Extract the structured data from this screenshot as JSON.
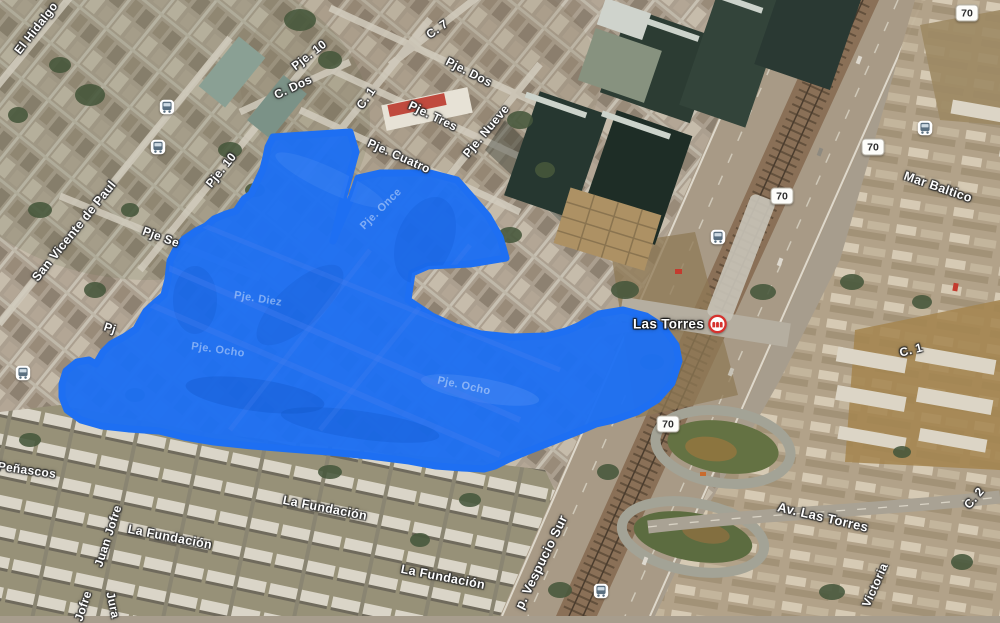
{
  "map": {
    "description": "Aerial satellite map with blue freehand area selection overlay, Las Torres / Av. Vespucio Sur area",
    "street_labels": [
      {
        "text": "El Hidalgo",
        "x": 36,
        "y": 28,
        "rotate": -52,
        "size": 12
      },
      {
        "text": "Pje. 10",
        "x": 309,
        "y": 55,
        "rotate": -38,
        "size": 12
      },
      {
        "text": "C. 7",
        "x": 437,
        "y": 29,
        "rotate": -35,
        "size": 12
      },
      {
        "text": "Pje. Dos",
        "x": 469,
        "y": 72,
        "rotate": 27,
        "size": 12
      },
      {
        "text": "C. Dos",
        "x": 293,
        "y": 87,
        "rotate": -25,
        "size": 12
      },
      {
        "text": "C. 1",
        "x": 366,
        "y": 98,
        "rotate": -55,
        "size": 12
      },
      {
        "text": "Pje. Tres",
        "x": 433,
        "y": 116,
        "rotate": 26,
        "size": 12
      },
      {
        "text": "Pje. Nueve",
        "x": 486,
        "y": 131,
        "rotate": -50,
        "size": 12
      },
      {
        "text": "Pje. Cuatro",
        "x": 399,
        "y": 156,
        "rotate": 24,
        "size": 12
      },
      {
        "text": "Pje. 10",
        "x": 221,
        "y": 170,
        "rotate": -51,
        "size": 12
      },
      {
        "text": "San Vicente de Paul",
        "x": 74,
        "y": 231,
        "rotate": -51,
        "size": 12.5
      },
      {
        "text": "Pje Se",
        "x": 161,
        "y": 237,
        "rotate": 20,
        "size": 12
      },
      {
        "text": "Pj",
        "x": 110,
        "y": 328,
        "rotate": 18,
        "size": 12
      },
      {
        "text": "Mar Baltico",
        "x": 938,
        "y": 187,
        "rotate": 19,
        "size": 12.5
      },
      {
        "text": "C. 1",
        "x": 911,
        "y": 350,
        "rotate": -14,
        "size": 12
      },
      {
        "text": "Peñascos",
        "x": 27,
        "y": 470,
        "rotate": 8,
        "size": 12
      },
      {
        "text": "Juan Jofre",
        "x": 108,
        "y": 536,
        "rotate": -72,
        "size": 12
      },
      {
        "text": "La Fundación",
        "x": 170,
        "y": 537,
        "rotate": 11,
        "size": 12.5
      },
      {
        "text": "La Fundación",
        "x": 325,
        "y": 508,
        "rotate": 11,
        "size": 12.5
      },
      {
        "text": "La Fundación",
        "x": 443,
        "y": 577,
        "rotate": 11,
        "size": 12.5
      },
      {
        "text": "Jofre",
        "x": 83,
        "y": 606,
        "rotate": -72,
        "size": 12
      },
      {
        "text": "Jura",
        "x": 113,
        "y": 605,
        "rotate": 78,
        "size": 12
      },
      {
        "text": "p. Vespucio Sur",
        "x": 541,
        "y": 562,
        "rotate": -64,
        "size": 13
      },
      {
        "text": "Av. Las Torres",
        "x": 823,
        "y": 517,
        "rotate": 13,
        "size": 13
      },
      {
        "text": "Victoria",
        "x": 875,
        "y": 585,
        "rotate": -66,
        "size": 12
      },
      {
        "text": "C. 2",
        "x": 974,
        "y": 498,
        "rotate": -50,
        "size": 12
      }
    ],
    "faint_street_labels": [
      {
        "text": "Pje. Once",
        "x": 381,
        "y": 209,
        "rotate": -45,
        "size": 11
      },
      {
        "text": "Pje. Diez",
        "x": 258,
        "y": 299,
        "rotate": 9,
        "size": 11
      },
      {
        "text": "Pje. Ocho",
        "x": 218,
        "y": 350,
        "rotate": 8,
        "size": 11
      },
      {
        "text": "Pje. Ocho",
        "x": 464,
        "y": 386,
        "rotate": 12,
        "size": 11
      }
    ],
    "route_shields": [
      {
        "text": "70",
        "x": 967,
        "y": 13
      },
      {
        "text": "70",
        "x": 873,
        "y": 147
      },
      {
        "text": "70",
        "x": 782,
        "y": 196
      },
      {
        "text": "70",
        "x": 668,
        "y": 424
      }
    ],
    "bus_stops": [
      {
        "x": 167,
        "y": 107
      },
      {
        "x": 158,
        "y": 147
      },
      {
        "x": 23,
        "y": 373
      },
      {
        "x": 718,
        "y": 237
      },
      {
        "x": 925,
        "y": 128
      },
      {
        "x": 601,
        "y": 591
      }
    ],
    "stations": [
      {
        "text": "Las Torres",
        "x": 680,
        "y": 324
      }
    ],
    "overlay": {
      "color": "#1e6ff2",
      "polygon_points": [
        [
          273,
          137
        ],
        [
          350,
          132
        ],
        [
          356,
          152
        ],
        [
          344,
          196
        ],
        [
          333,
          241
        ],
        [
          352,
          196
        ],
        [
          358,
          178
        ],
        [
          380,
          173
        ],
        [
          430,
          173
        ],
        [
          457,
          180
        ],
        [
          471,
          196
        ],
        [
          488,
          216
        ],
        [
          500,
          237
        ],
        [
          506,
          258
        ],
        [
          470,
          264
        ],
        [
          428,
          266
        ],
        [
          412,
          273
        ],
        [
          408,
          300
        ],
        [
          432,
          316
        ],
        [
          456,
          327
        ],
        [
          481,
          334
        ],
        [
          511,
          337
        ],
        [
          546,
          336
        ],
        [
          566,
          331
        ],
        [
          578,
          326
        ],
        [
          599,
          314
        ],
        [
          623,
          310
        ],
        [
          646,
          316
        ],
        [
          663,
          327
        ],
        [
          676,
          345
        ],
        [
          679,
          361
        ],
        [
          672,
          383
        ],
        [
          657,
          400
        ],
        [
          637,
          412
        ],
        [
          614,
          420
        ],
        [
          596,
          424
        ],
        [
          577,
          432
        ],
        [
          549,
          443
        ],
        [
          526,
          452
        ],
        [
          509,
          459
        ],
        [
          495,
          466
        ],
        [
          484,
          469
        ],
        [
          462,
          468
        ],
        [
          436,
          466
        ],
        [
          409,
          461
        ],
        [
          369,
          456
        ],
        [
          329,
          452
        ],
        [
          289,
          449
        ],
        [
          252,
          446
        ],
        [
          214,
          442
        ],
        [
          184,
          437
        ],
        [
          159,
          431
        ],
        [
          129,
          429
        ],
        [
          102,
          426
        ],
        [
          81,
          420
        ],
        [
          67,
          410
        ],
        [
          62,
          397
        ],
        [
          62,
          384
        ],
        [
          66,
          371
        ],
        [
          77,
          362
        ],
        [
          89,
          360
        ],
        [
          96,
          364
        ],
        [
          103,
          352
        ],
        [
          111,
          344
        ],
        [
          124,
          337
        ],
        [
          136,
          329
        ],
        [
          146,
          311
        ],
        [
          157,
          301
        ],
        [
          164,
          295
        ],
        [
          168,
          279
        ],
        [
          170,
          261
        ],
        [
          176,
          249
        ],
        [
          184,
          239
        ],
        [
          196,
          231
        ],
        [
          206,
          226
        ],
        [
          214,
          219
        ],
        [
          226,
          214
        ],
        [
          236,
          211
        ],
        [
          244,
          199
        ],
        [
          251,
          194
        ],
        [
          256,
          184
        ],
        [
          263,
          169
        ],
        [
          266,
          157
        ],
        [
          268,
          147
        ]
      ]
    }
  }
}
